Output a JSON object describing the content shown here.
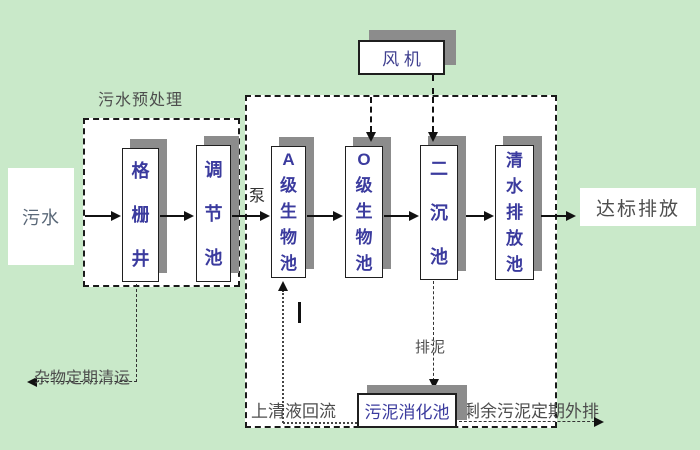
{
  "colors": {
    "background": "#c9e9c9",
    "region_fill": "#ffffff",
    "box_shadow": "#8c8c8c",
    "tank_text": "#3b3b9e",
    "label_text": "#4d4d4d",
    "line": "#111111"
  },
  "diagram": {
    "influent_label": "污水",
    "pretreatment_label": "污水预处理",
    "pump_label": "泵",
    "fan_label": "风 机",
    "effluent_label": "达标排放",
    "debris_label": "杂物定期清运",
    "supernatant_label": "上清液回流",
    "sludge_drain_label": "排泥",
    "excess_sludge_label": "剩余污泥定期外排",
    "digestion_label": "污泥消化池",
    "tanks": [
      {
        "name": "grid-well",
        "label": "格栅井"
      },
      {
        "name": "regulating-tank",
        "label": "调节池"
      },
      {
        "name": "a-bio-tank",
        "label": "A级生物池"
      },
      {
        "name": "o-bio-tank",
        "label": "O级生物池"
      },
      {
        "name": "secondary-sedimentation-tank",
        "label": "二沉池"
      },
      {
        "name": "clean-water-discharge-tank",
        "label": "清水排放池"
      }
    ]
  }
}
